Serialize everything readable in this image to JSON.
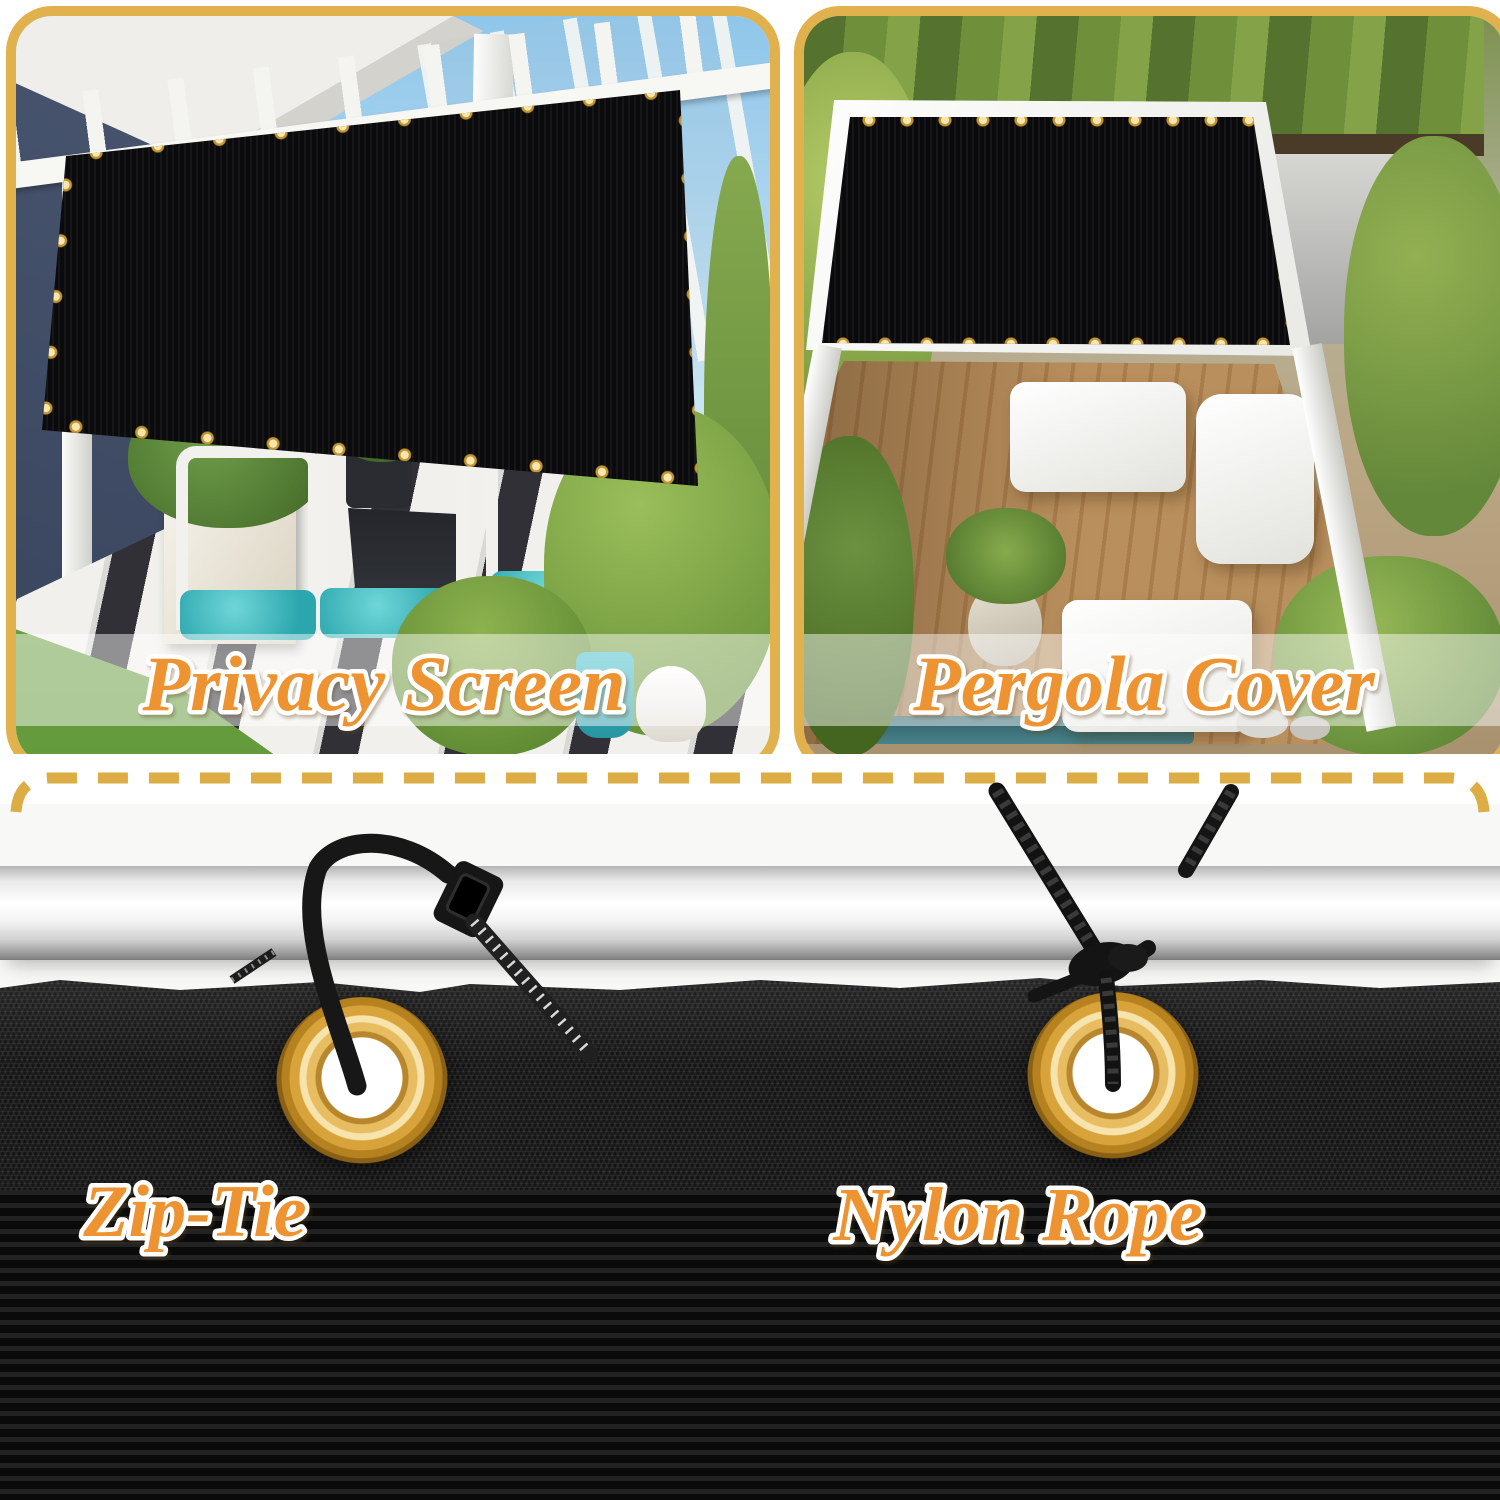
{
  "top_panels": {
    "left": {
      "label": "Privacy Screen"
    },
    "right": {
      "label": "Pergola Cover"
    }
  },
  "bottom_section": {
    "left_label": "Zip-Tie",
    "right_label": "Nylon Rope"
  },
  "colors": {
    "label_text": "#ED9332",
    "label_outline": "#FFFFFF",
    "panel_frame_gold": "#E0B14C",
    "dashed_line_gold": "#DDAD45",
    "grommet_brass": "#D9A43B",
    "mesh_black": "#141414",
    "pole_silver": "#E6E6E6"
  }
}
